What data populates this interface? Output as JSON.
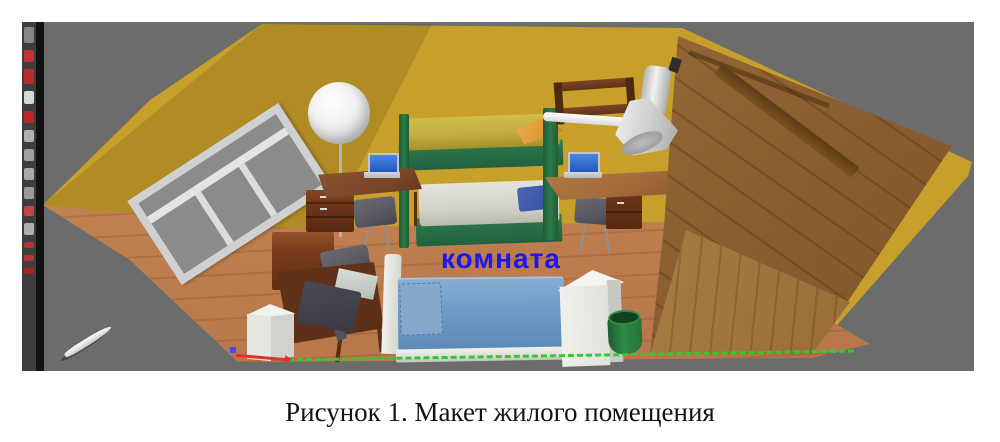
{
  "figure": {
    "caption": "Рисунок 1. Макет жилого помещения"
  },
  "viewport": {
    "room_label": "комната"
  },
  "toolbar": {
    "icons": [
      {
        "name": "active-tool-icon",
        "color": "#8a8a8a",
        "h": 16
      },
      {
        "name": "partial-tool-icon-red-1",
        "color": "#cc3333",
        "h": 12
      },
      {
        "name": "partial-tool-icon-red-2",
        "color": "#c42b2b",
        "h": 15
      },
      {
        "name": "partial-tool-icon-gray-1",
        "color": "#e0e0e0",
        "h": 13
      },
      {
        "name": "partial-tool-icon-red-3",
        "color": "#c22424",
        "h": 12
      },
      {
        "name": "partial-tool-icon-gray-2",
        "color": "#b8b8b8",
        "h": 12
      },
      {
        "name": "partial-tool-icon-gray-3",
        "color": "#a8a8a8",
        "h": 12
      },
      {
        "name": "partial-tool-icon-gray-4",
        "color": "#b0b0b0",
        "h": 12
      },
      {
        "name": "partial-tool-icon-gray-5",
        "color": "#9f9f9f",
        "h": 12
      },
      {
        "name": "partial-tool-icon-red-4",
        "color": "#cc4444",
        "h": 10
      },
      {
        "name": "partial-tool-icon-gray-6",
        "color": "#b5b5b5",
        "h": 12
      },
      {
        "name": "partial-tool-icon-red-5",
        "color": "#c03030",
        "h": 6
      },
      {
        "name": "partial-tool-icon-red-6",
        "color": "#c03030",
        "h": 6
      },
      {
        "name": "partial-tool-icon-red-7",
        "color": "#b02020",
        "h": 5
      }
    ]
  },
  "colors": {
    "viewportBg": "#6c6c6c",
    "toolbarBg": "#3e3e3e",
    "toolbarEdge": "#121212",
    "wall": "#c79f2b",
    "floor": "#c08150",
    "wardrobeTop": "#936635",
    "wardrobeFront": "#a97e47",
    "bedGreen": "#2c7c4a",
    "mattressYellow": "#c3ad3e",
    "pillowOrange": "#dd9434",
    "mattressPale": "#d3d4c9",
    "pillowNavy": "#3a55a4",
    "bedBlue": "#6d9ac5",
    "pillowBlue": "#84a9cc",
    "frameWhite": "#dededa",
    "deskBrown": "#7a4628",
    "deskLight": "#a06838",
    "deskDark": "#5c2f16",
    "drawerBrown": "#6b3518",
    "shelfBrown": "#5f3319",
    "chairGray": "#585862",
    "laptopScreen": "#2a64c8",
    "laptopBody": "#b9b9bd",
    "monitorDark": "#3a3a44",
    "cubeWhite": "#e6e6e1",
    "binGreen": "#2f8a46",
    "axisGreen": "#2ecc2e",
    "axisRed": "#e03030",
    "axisBlue": "#4848ff",
    "glassGray": "#8b8b8b",
    "windowFrame": "#d0d0d0",
    "labelBlue": "#1d18ee",
    "captionColor": "#141414"
  }
}
